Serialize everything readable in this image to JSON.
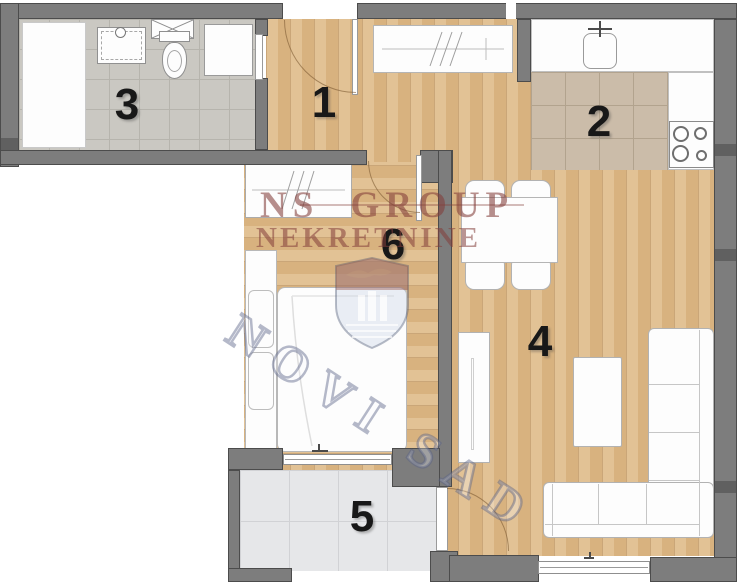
{
  "rooms": [
    {
      "id": "hallway",
      "label": "1"
    },
    {
      "id": "kitchen",
      "label": "2"
    },
    {
      "id": "bathroom",
      "label": "3"
    },
    {
      "id": "living-room",
      "label": "4"
    },
    {
      "id": "terrace",
      "label": "5"
    },
    {
      "id": "bedroom",
      "label": "6"
    }
  ],
  "watermark": {
    "brand_line1": "NS GROUP",
    "brand_line2": "NEKRETNINE",
    "city": "NOVI SAD"
  },
  "colors": {
    "wall": "#7d7d7d",
    "wood_floor": "#dcba8c",
    "bathroom_tile": "#cac8c2",
    "kitchen_tile": "#cbbca9",
    "terrace_tile": "#e6e7e9",
    "watermark_text": "#833a3a",
    "watermark_city_outline": "#5f6487",
    "crest_top": "#8a4a42",
    "crest_bottom": "#a9bccf"
  },
  "fixtures": {
    "bathroom": [
      "shower-tray",
      "washbasin-vanity",
      "washing-machine",
      "toilet",
      "cabinet"
    ],
    "kitchen": [
      "counter",
      "sink",
      "faucet",
      "stove"
    ],
    "dining": [
      "table",
      "chair",
      "chair",
      "chair",
      "chair"
    ],
    "living": [
      "tv-stand",
      "coffee-table",
      "corner-sofa"
    ],
    "bedroom": [
      "mirror-wardrobe",
      "closet",
      "bed"
    ],
    "hallway": [
      "mirror-wardrobe",
      "entrance-door"
    ],
    "doors": [
      "entrance-door",
      "bathroom-door",
      "bedroom-door",
      "terrace-door"
    ],
    "windows": [
      "bedroom-terrace-window",
      "living-room-window"
    ]
  }
}
